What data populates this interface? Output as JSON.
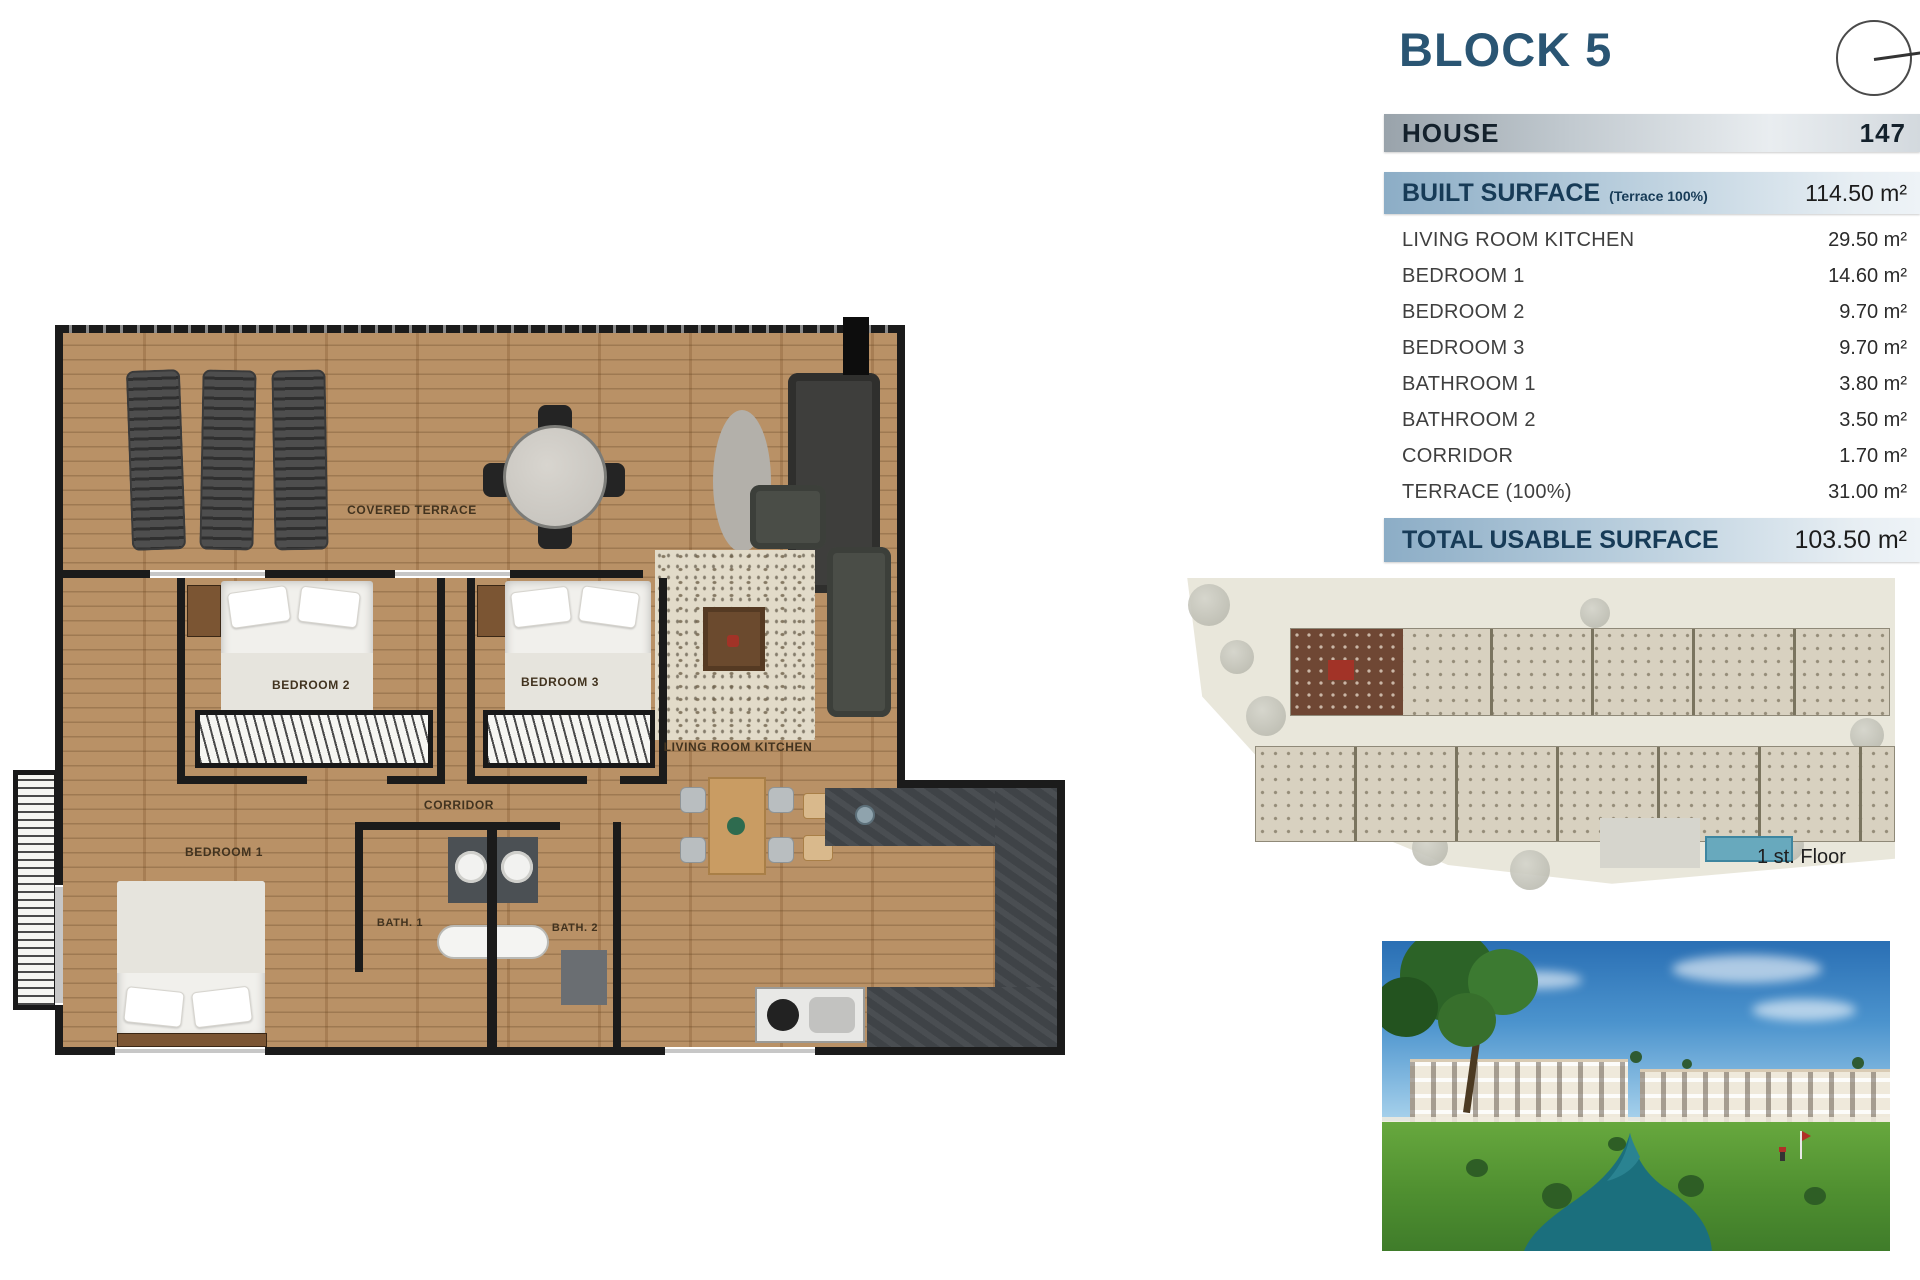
{
  "header": {
    "block_title": "BLOCK 5",
    "house_label": "HOUSE",
    "house_number": "147"
  },
  "surface": {
    "built_label": "BUILT SURFACE",
    "built_note": "(Terrace 100%)",
    "built_value": "114.50 m²",
    "rows": [
      {
        "label": "LIVING ROOM KITCHEN",
        "value": "29.50 m²"
      },
      {
        "label": "BEDROOM 1",
        "value": "14.60 m²"
      },
      {
        "label": "BEDROOM 2",
        "value": "9.70 m²"
      },
      {
        "label": "BEDROOM 3",
        "value": "9.70 m²"
      },
      {
        "label": "BATHROOM 1",
        "value": "3.80 m²"
      },
      {
        "label": "BATHROOM 2",
        "value": "3.50 m²"
      },
      {
        "label": "CORRIDOR",
        "value": "1.70 m²"
      },
      {
        "label": "TERRACE (100%)",
        "value": "31.00 m²"
      }
    ],
    "total_label": "TOTAL USABLE SURFACE",
    "total_value": "103.50 m²"
  },
  "plan": {
    "covered_terrace": "COVERED TERRACE",
    "bedroom1": "BEDROOM 1",
    "bedroom2": "BEDROOM 2",
    "bedroom3": "BEDROOM 3",
    "corridor": "CORRIDOR",
    "living": "LIVING ROOM KITCHEN",
    "bath1": "BATH. 1",
    "bath2": "BATH. 2"
  },
  "site": {
    "caption": "1 st. Floor"
  },
  "icons": {
    "compass": "compass-dial"
  },
  "colors": {
    "title_blue": "#2a5573",
    "navy_text": "#173b57",
    "bar_blue": "#8cadc6",
    "bar_gray": "#99a3ab",
    "text_dark": "#3f3f3f",
    "wood": "#b58b5e",
    "highlight_unit": "#6f4734",
    "water": "#1b6f7d"
  }
}
